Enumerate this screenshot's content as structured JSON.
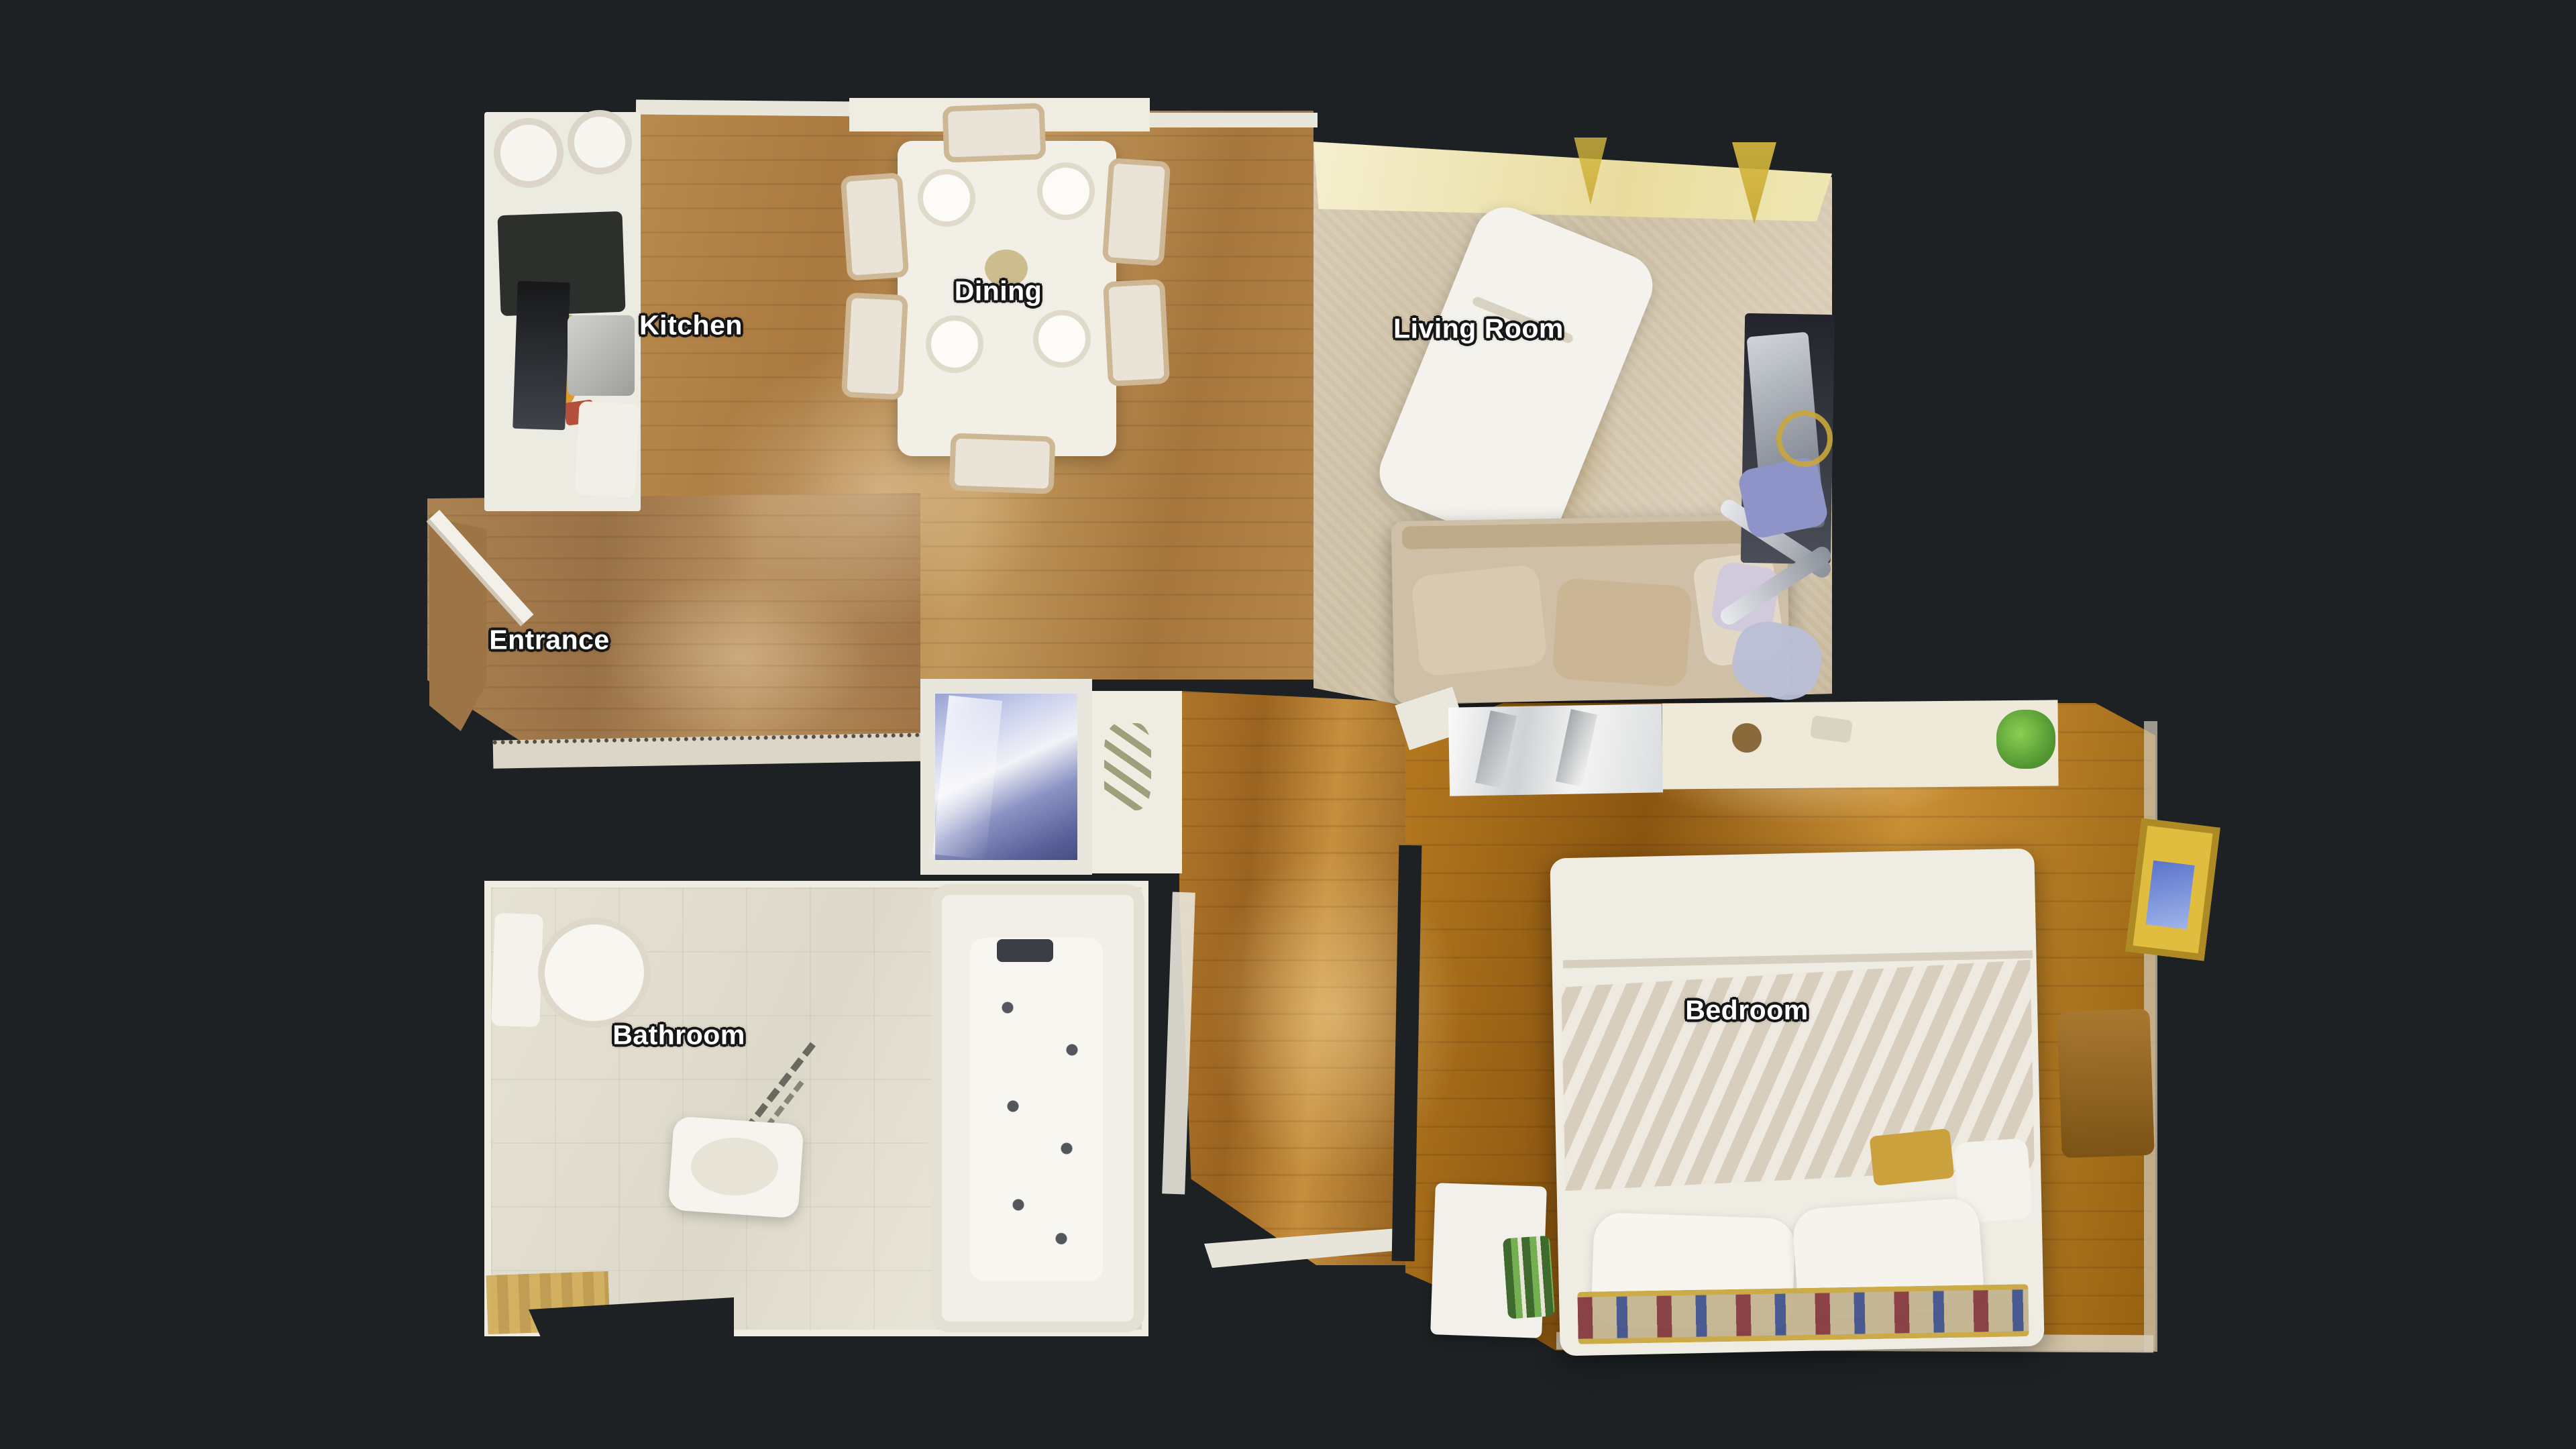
{
  "canvas": {
    "view": "floor-plan",
    "background": "#1d2123"
  },
  "floorplan": {
    "rooms": [
      {
        "id": "kitchen",
        "label": "Kitchen"
      },
      {
        "id": "dining",
        "label": "Dining"
      },
      {
        "id": "living-room",
        "label": "Living Room"
      },
      {
        "id": "entrance",
        "label": "Entrance"
      },
      {
        "id": "bathroom",
        "label": "Bathroom"
      },
      {
        "id": "bedroom",
        "label": "Bedroom"
      }
    ],
    "palette": {
      "background": "#1d2123",
      "wood_floor": "#b0813f",
      "wood_floor_dark": "#8f5c1d",
      "carpet": "#cfc2a8",
      "tile": "#e2dfd2",
      "fixture_white": "#f2f0e8",
      "accent_gold": "#c9a63c",
      "accent_blue": "#8e93c8",
      "label_text": "#ffffff",
      "label_outline": "#161616"
    }
  }
}
